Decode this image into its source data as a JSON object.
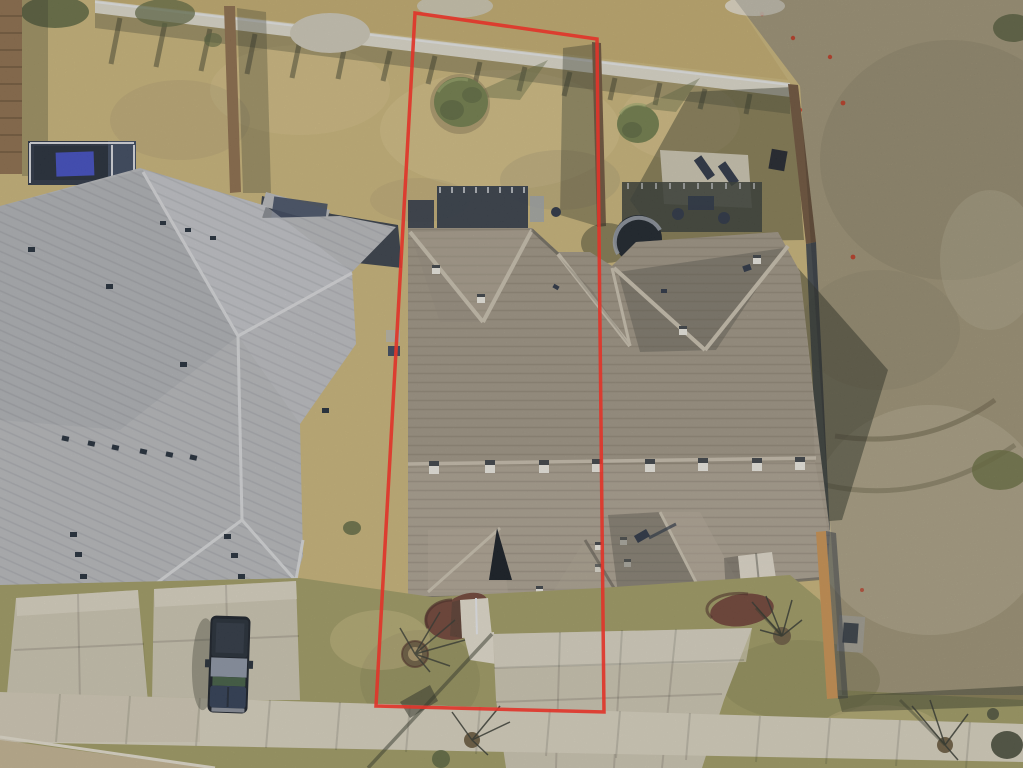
{
  "scene": {
    "description": "Aerial drone photograph of a duplex residential lot; a red surveyed property boundary outlines the left duplex unit and its narrow yard strip. Neighboring gray-roofed house on the left, dry tan lawns, wooden fences, backyard decks and hot tub, concrete driveways and a diagonal sidewalk at bottom, vacant scrubby lot on the right.",
    "objects": [
      "property-boundary-outline",
      "duplex-roof",
      "left-house-roof",
      "backyard-lawn",
      "vacant-lot",
      "retaining-wall",
      "wood-fences",
      "hot-tub",
      "back-deck",
      "patio-slab",
      "shrubs",
      "mulch-beds",
      "front-porch",
      "roof-vents",
      "skylight",
      "driveways",
      "sidewalk",
      "pickup-truck",
      "street-trees",
      "utility-pad",
      "survey-flags"
    ],
    "palette": {
      "grassBack": "#c8b377",
      "grassTop": "#c0aa6c",
      "grassPale": "#d6c38c",
      "field": "#b5a987",
      "fieldDark": "#94886b",
      "fieldLight": "#cfc5a4",
      "lawnFront": "#9e9a62",
      "lawnDark": "#7d7a4c",
      "wall": "#dcd8ca",
      "concrete": "#d7d0be",
      "concrete2": "#cbc4b0",
      "concrete3": "#e2dccd",
      "roofGray": "#b6b8bc",
      "roofGrayLight": "#c9cbcf",
      "roofGrayDark": "#9da0a6",
      "roofRidgeGray": "#dadcdf",
      "roofTan": "#a39888",
      "roofTanDark": "#92887a",
      "roofTanLight": "#b3a999",
      "roofRidgeTan": "#c8bfae",
      "shadow": "#2e3224",
      "navy": "#273142",
      "navyLight": "#39455c",
      "blueTarp": "#3c49c0",
      "fence": "#8a6a48",
      "fenceDark": "#6b5138",
      "fenceLit": "#c98f4e",
      "mulch": "#6e4034",
      "mulchDark": "#4a2a22",
      "treeGreen": "#6f7c49",
      "treeGreenDark": "#55603a",
      "gravel": "#ccc6b6",
      "dirt": "#c2b290",
      "utility": "#b8b4a6",
      "red": "#e0352a",
      "truckBody": "#2b3952",
      "truckGreen": "#3e5a41"
    }
  },
  "boundary": {
    "color": "#e0352a",
    "points": "415,13 597,39 604,712 376,706"
  }
}
